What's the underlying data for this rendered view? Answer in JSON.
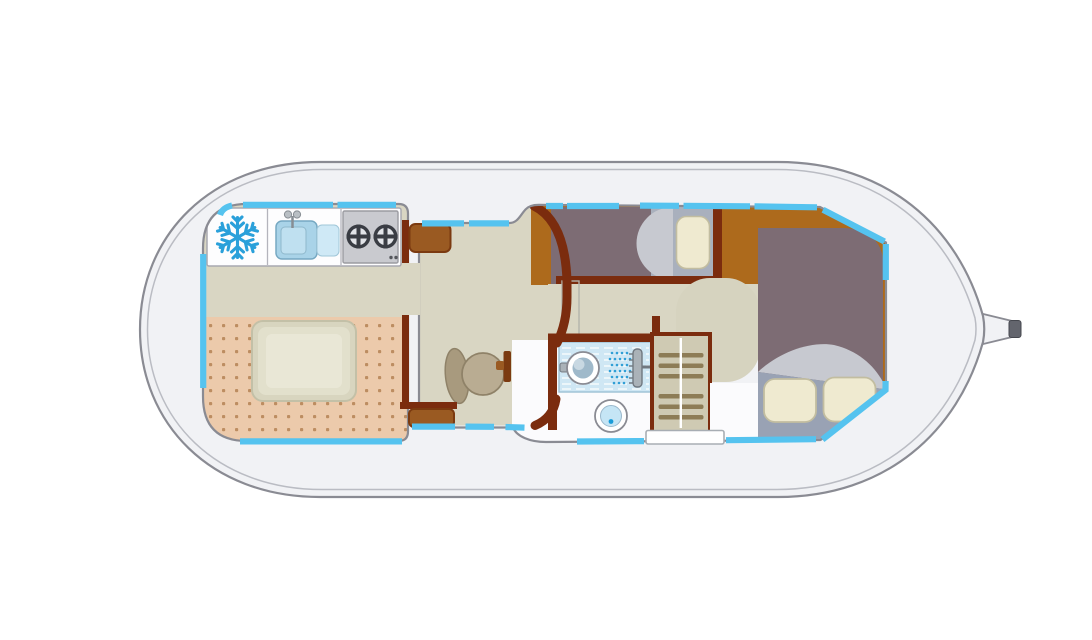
{
  "title": "Houseboat deck floor plan",
  "type": "floor-plan",
  "boat": {
    "orientation": "bow-left",
    "stern_feature": "tiller",
    "window_segment_count": 17
  },
  "rooms": {
    "saloon": {
      "name": "saloon-dinette",
      "fixtures": [
        "dining-table",
        "carpet"
      ]
    },
    "galley": {
      "name": "galley",
      "fixtures": [
        "refrigerator",
        "kitchen-sink",
        "two-burner-stove"
      ]
    },
    "helm": {
      "name": "helm-station",
      "fixtures": [
        "helm-seat",
        "steering-pedestal",
        "instrument-panel"
      ]
    },
    "single_cabin": {
      "name": "single-berth-cabin",
      "fixtures": [
        "single-bed"
      ],
      "pillows": 1
    },
    "corridor": {
      "name": "corridor",
      "fixtures": []
    },
    "bathroom": {
      "name": "bathroom",
      "fixtures": [
        "shower",
        "washbasin",
        "toilet"
      ]
    },
    "wardrobe": {
      "name": "louvered-wardrobe",
      "slats": 6
    },
    "aft_cabin": {
      "name": "aft-double-cabin",
      "fixtures": [
        "double-bed"
      ],
      "pillows": 2
    },
    "entrance": {
      "name": "side-entrance",
      "fixtures": [
        "door-threshold"
      ]
    }
  },
  "icons": {
    "refrigerator": "snowflake-icon",
    "stove": "burner-ring-icon",
    "shower": "shower-head-icon",
    "panel_lights": [
      "red-indicator",
      "green-indicator"
    ]
  },
  "colors": {
    "bg": "#ffffff",
    "hull_fill": "#f1f2f5",
    "hull_stroke": "#8a8b93",
    "hull_inner_stroke": "#babcc3",
    "window": "#55c3ef",
    "wall": "#7b2c0e",
    "wood": "#ad6a1c",
    "cabinet": "#9a5a22",
    "cabinet_border": "#7b3a10",
    "floor": "#d9d6c3",
    "floor_light": "#d6d3bf",
    "carpet": "#eccaab",
    "carpet_dot": "#bd8d61",
    "counter": "#fdfdfe",
    "stove": "#c9cacf",
    "burner": "#3a3d44",
    "burner_face": "#e2e4e8",
    "sink_blue": "#a9d3e8",
    "sink_blue_light": "#cfe9f6",
    "snowflake": "#2aa0da",
    "bed": "#7d6c74",
    "bed_base": "#a9b0bd",
    "blanket": "#c7c9d0",
    "mattress": "#99a2b4",
    "pillow": "#efead0",
    "pillow_border": "#c2bda0",
    "bath_floor": "#fbfbfd",
    "tray": "#cfe7f4",
    "tray_border": "#9cc0d4",
    "spray": "#2f9fd6",
    "porcelain": "#ffffff",
    "fixture_rim": "#8a8b93",
    "toilet_water": "#c5e5f5",
    "water_dot": "#1a9cd8",
    "basin_inner": "#9fb9ca",
    "wardrobe": "#cfcab3",
    "slat": "#8d7c56",
    "seat": "#b9ac92",
    "seat_back": "#a89a7e",
    "seat_border": "#8f8268",
    "panel": "#b6b6be",
    "panel_border": "#8e8e96",
    "indicator_red": "#e03416",
    "indicator_green": "#76c91c",
    "screen": "#ffffff",
    "door": "#ffffff",
    "tiller_cap": "#63656d",
    "table": "#d8d5bf",
    "table_border": "#c3c0a7",
    "table_top": "#e2e0cc",
    "table_highlight": "#e9e7d6"
  }
}
